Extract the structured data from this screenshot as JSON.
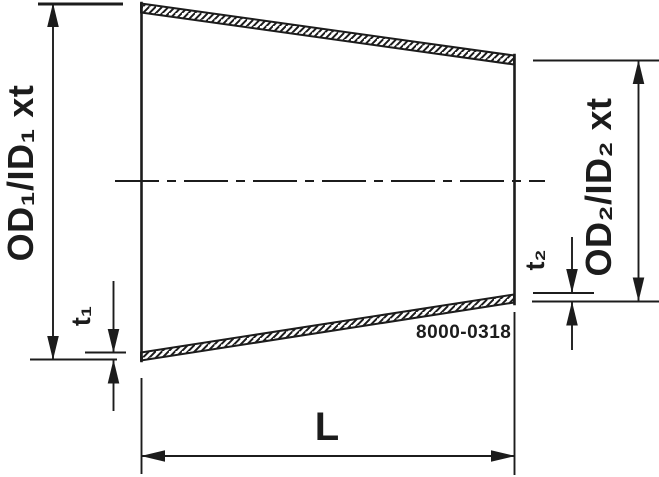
{
  "drawing": {
    "description": "Concentric reducer dimension drawing",
    "labels": {
      "od1": "OD₁/ID₁ xt",
      "od2": "OD₂/ID₂ xt",
      "t1": "t₁",
      "t2": "t₂",
      "length": "L",
      "part_number": "8000-0318"
    },
    "colors": {
      "line": "#1c1c1c",
      "background": "#ffffff"
    }
  }
}
